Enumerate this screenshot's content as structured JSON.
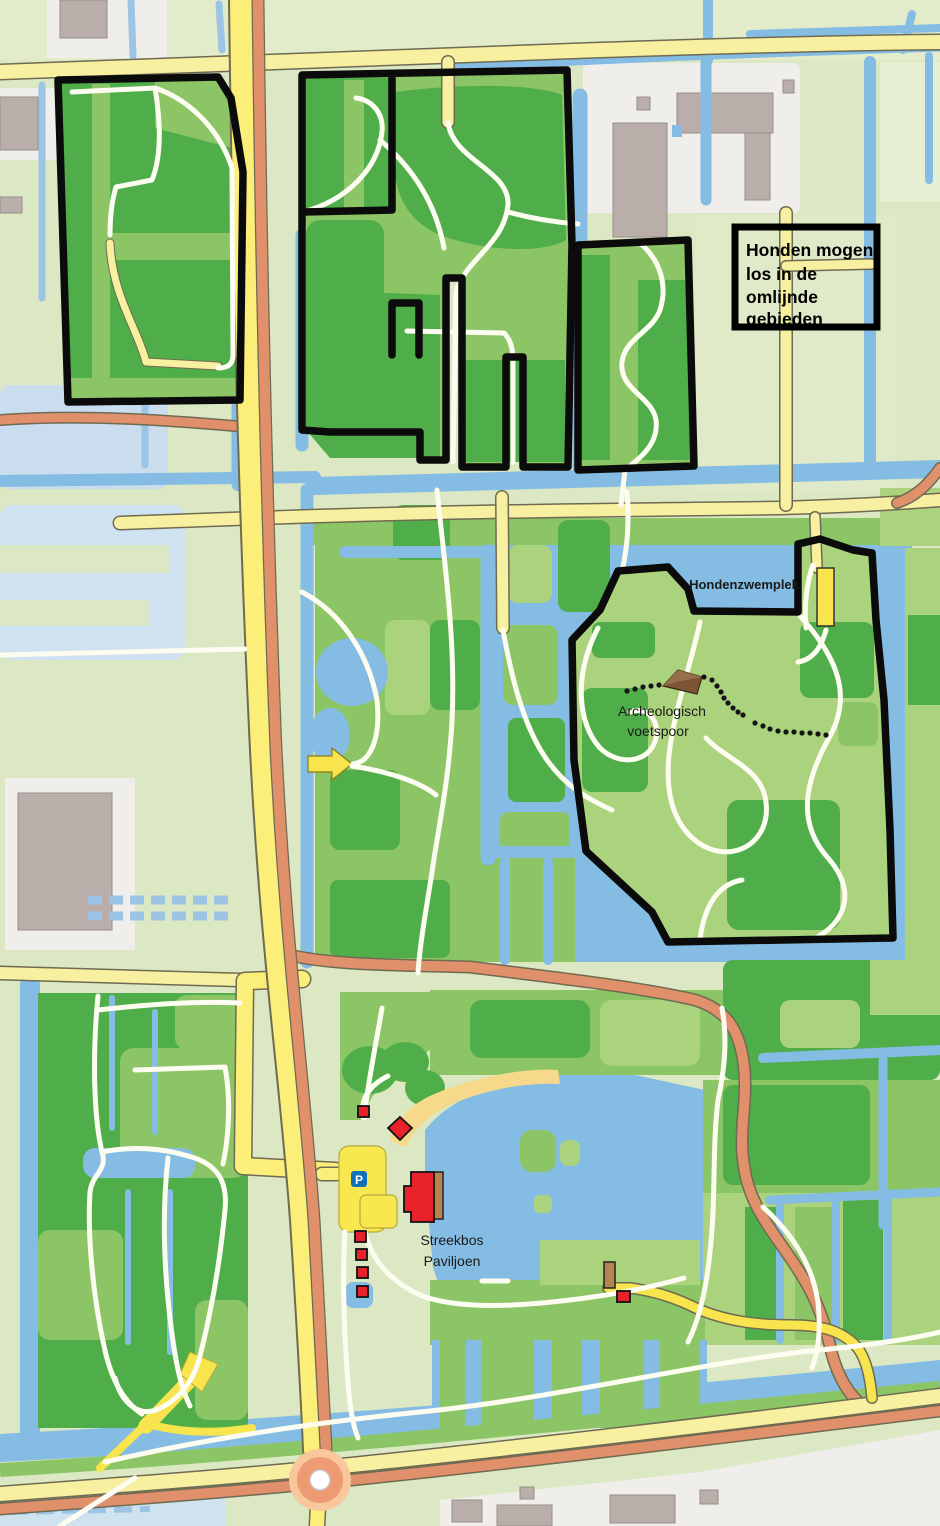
{
  "legend": {
    "lines": [
      "Honden mogen",
      "los in de",
      "omlijnde",
      "gebieden"
    ]
  },
  "labels": {
    "dog_swim_area": "Hondenzwemplek",
    "archaeological_site_line1": "Archeologisch",
    "archaeological_site_line2": "voetspoor",
    "pavilion_line1": "Streekbos",
    "pavilion_line2": "Paviljoen",
    "parking_symbol": "P"
  },
  "colors": {
    "background": "#dce8c3",
    "water": "#85bce3",
    "forest_dark": "#4fae49",
    "forest_mid": "#8cc565",
    "forest_light": "#abd37d",
    "road_yellow": "#f7f0a0",
    "road_main_yellow": "#fbee79",
    "road_salmon": "#e1906c",
    "structure_yellow": "#f8e44c",
    "dog_area_outline": "#0b0b0b",
    "building_red": "#e8222b",
    "building_brown": "#b5854f",
    "building_gray": "#b9aeaa",
    "sand": "#f6d98b",
    "parking_blue": "#1270b8",
    "path_white": "#fdfcf0"
  }
}
